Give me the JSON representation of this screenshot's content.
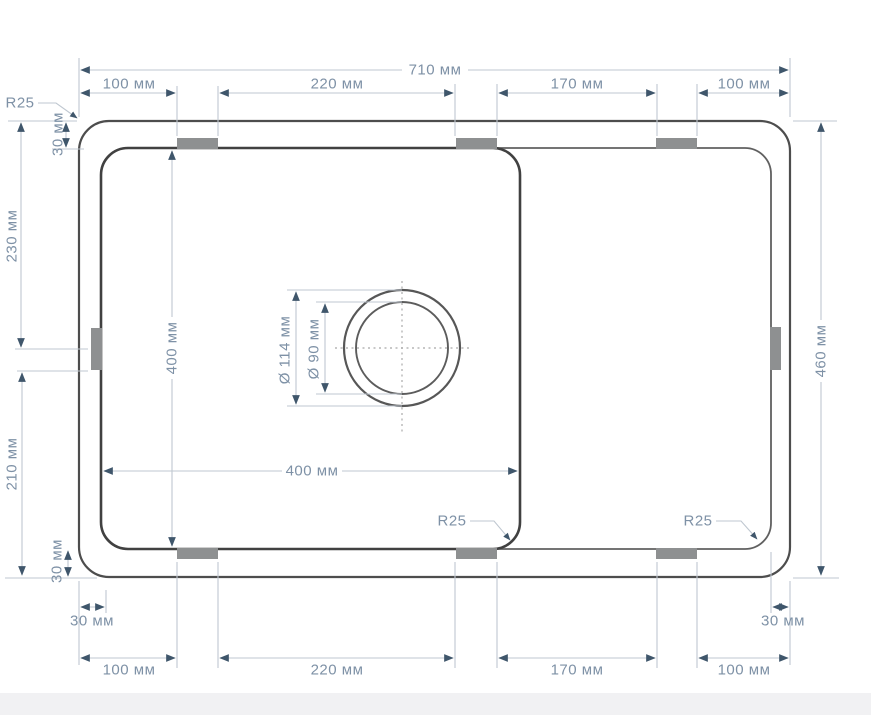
{
  "dims": {
    "overall_width": "710 мм",
    "overall_height": "460 мм",
    "top_segments": [
      "100 мм",
      "220 мм",
      "170 мм",
      "100 мм"
    ],
    "bottom_segments": [
      "100 мм",
      "220 мм",
      "170 мм",
      "100 мм"
    ],
    "left_upper": "230 мм",
    "left_lower": "210 мм",
    "bowl_width": "400 мм",
    "bowl_depth": "400 мм",
    "drain_outer_diameter": "Ø 114 мм",
    "drain_inner_diameter": "Ø 90 мм",
    "rim_top_left": "30 мм",
    "rim_bottom_left": "30 мм",
    "edge_inset_bottom_left": "30 мм",
    "edge_inset_bottom_right": "30 мм"
  },
  "radii": {
    "top_left": "R25",
    "bottom_center": "R25",
    "bottom_right": "R25"
  },
  "colors": {
    "outline": "#4d4d4d",
    "dimension_line": "#bfc7d0",
    "dimension_text": "#7e91a6",
    "arrow": "#3f566b",
    "tab_fill": "#8e9091"
  }
}
